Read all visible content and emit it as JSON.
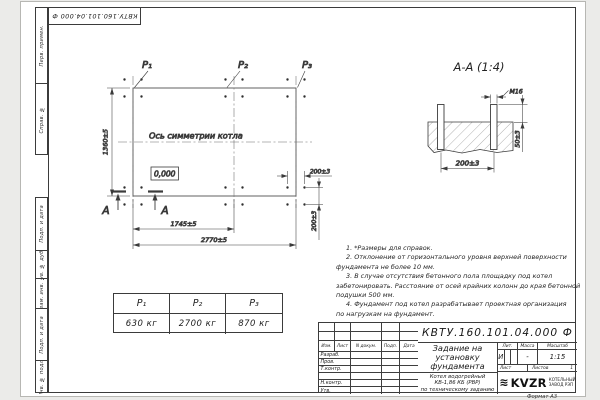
{
  "doc_number": "КВТУ.160.101.04.000  Ф",
  "format_label": "Формат А3",
  "margin_strip": {
    "perv_primen": "Перв. примен.",
    "sprav_no": "Справ. №",
    "podp_data_top": "Подп. и дата",
    "inv_dubl": "Инв. № дубл.",
    "vzam_inv": "Взам. инв. №",
    "podp_data_bottom": "Подп. и дата",
    "inv_podl": "Инв. № подл."
  },
  "plan": {
    "load_labels": [
      "Р₁",
      "Р₂",
      "Р₃"
    ],
    "symmetry_label": "Ось симметрии котла",
    "elevation": "0,000",
    "section_letter": "А",
    "dim_height": "1360±5",
    "dim_mid_span": "1745±5",
    "dim_total_span": "2770±5",
    "dim_group_x": "200±3",
    "dim_group_y": "200±3"
  },
  "section_view": {
    "title": "А-А (1:4)",
    "thread_label": "М16",
    "dim_bolt_spacing": "200±3",
    "dim_protrusion": "50±3"
  },
  "loads_table": {
    "headers": [
      "Р₁",
      "Р₂",
      "Р₃"
    ],
    "values": [
      "630 кг",
      "2700 кг",
      "870 кг"
    ]
  },
  "notes": {
    "lines": [
      "1. *Размеры для справок.",
      "2. Отклонение от горизонтального уровня верхней поверхности",
      "фундамента не более 10 мм.",
      "3. В случае отсутствия бетонного пола площадку под котел",
      "забетонировать. Расстояние от осей крайних колонн до края бетонной",
      "подушки 500 мм.",
      "4. Фундамент под котел разрабатывает проектная организация",
      "по нагрузкам на фундамент."
    ]
  },
  "title_block": {
    "doc_number": "КВТУ.160.101.04.000  Ф",
    "header_cols": [
      "Изм.",
      "Лист",
      "N докум.",
      "Подп.",
      "Дата"
    ],
    "row_labels": [
      "Разраб.",
      "Пров.",
      "Т.контр.",
      "",
      "Н.контр.",
      "Утв."
    ],
    "title_lines": [
      "Задание на",
      "установку",
      "фундамента"
    ],
    "product_lines": [
      "Котел водогрейный",
      "КВ-1,86 КБ (РВР)",
      "по техническому заданию"
    ],
    "lit_label": "Лит.",
    "mass_label": "Масса",
    "scale_label": "Масштаб",
    "lit_value": "И",
    "mass_value": "-",
    "scale_value": "1:15",
    "sheet_label": "Лист",
    "sheets_label": "Листов",
    "sheets_value": "1",
    "logo_text": "KVZR",
    "logo_caption_lines": [
      "КОТЕЛЬНЫЙ",
      "ЗАВОД РЭП"
    ]
  }
}
